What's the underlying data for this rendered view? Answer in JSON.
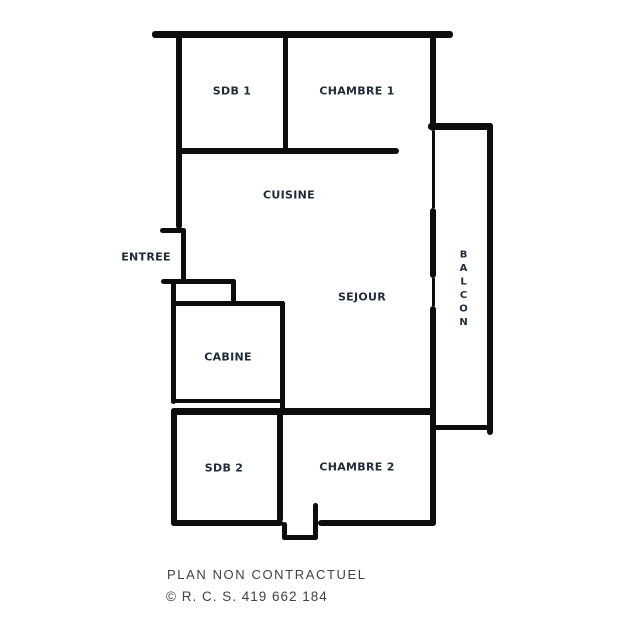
{
  "plan": {
    "rooms": {
      "sdb1": {
        "label": "SDB 1"
      },
      "chambre1": {
        "label": "CHAMBRE 1"
      },
      "cuisine": {
        "label": "CUISINE"
      },
      "entree": {
        "label": "ENTREE"
      },
      "sejour": {
        "label": "SEJOUR"
      },
      "cabine": {
        "label": "CABINE"
      },
      "balcon": {
        "label": "BALCON"
      },
      "sdb2": {
        "label": "SDB 2"
      },
      "chambre2": {
        "label": "CHAMBRE 2"
      }
    }
  },
  "footer": {
    "disclaimer": "PLAN NON CONTRACTUEL",
    "registration": "© R. C. S. 419 662 184"
  },
  "colors": {
    "wall": "#0d0d0d",
    "room_label": "#202c3a",
    "footer_text": "#3f4245",
    "background": "#ffffff"
  }
}
